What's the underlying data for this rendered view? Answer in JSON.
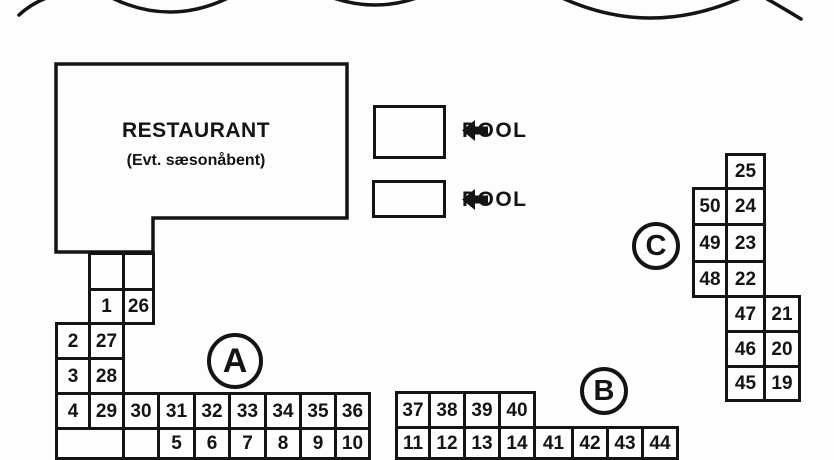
{
  "canvas": {
    "background_color": "#fdfdfd",
    "line_color": "#141414"
  },
  "restaurant": {
    "title": "RESTAURANT",
    "subtitle": "(Evt. sæsonåbent)"
  },
  "pools": [
    {
      "label": "POOL",
      "arrow_direction": "left"
    },
    {
      "label": "POOL",
      "arrow_direction": "left"
    }
  ],
  "blocks": [
    {
      "id": "block-a",
      "section_label": "A",
      "circle": {
        "cx": 235,
        "cy": 361,
        "r": 28,
        "font_size": 34
      },
      "cells": [
        {
          "label": "",
          "rect": [
            88,
            252,
            37,
            39
          ]
        },
        {
          "label": "",
          "rect": [
            122,
            252,
            33,
            39
          ]
        },
        {
          "label": "1",
          "rect": [
            88,
            288,
            37,
            37
          ]
        },
        {
          "label": "26",
          "rect": [
            122,
            288,
            33,
            37
          ]
        },
        {
          "label": "2",
          "rect": [
            55,
            322,
            36,
            38
          ]
        },
        {
          "label": "27",
          "rect": [
            88,
            322,
            37,
            38
          ]
        },
        {
          "label": "3",
          "rect": [
            55,
            357,
            36,
            38
          ]
        },
        {
          "label": "28",
          "rect": [
            88,
            357,
            37,
            38
          ]
        },
        {
          "label": "4",
          "rect": [
            55,
            392,
            36,
            38
          ]
        },
        {
          "label": "29",
          "rect": [
            88,
            392,
            37,
            38
          ]
        },
        {
          "label": "30",
          "rect": [
            122,
            392,
            38,
            38
          ]
        },
        {
          "label": "31",
          "rect": [
            157,
            392,
            39,
            38
          ]
        },
        {
          "label": "32",
          "rect": [
            193,
            392,
            38,
            38
          ]
        },
        {
          "label": "33",
          "rect": [
            228,
            392,
            39,
            38
          ]
        },
        {
          "label": "34",
          "rect": [
            264,
            392,
            38,
            38
          ]
        },
        {
          "label": "35",
          "rect": [
            299,
            392,
            38,
            38
          ]
        },
        {
          "label": "36",
          "rect": [
            334,
            392,
            37,
            38
          ]
        },
        {
          "label": "",
          "rect": [
            55,
            427,
            70,
            33
          ]
        },
        {
          "label": "",
          "rect": [
            122,
            427,
            38,
            33
          ]
        },
        {
          "label": "5",
          "rect": [
            157,
            427,
            39,
            33
          ]
        },
        {
          "label": "6",
          "rect": [
            193,
            427,
            38,
            33
          ]
        },
        {
          "label": "7",
          "rect": [
            228,
            427,
            39,
            33
          ]
        },
        {
          "label": "8",
          "rect": [
            264,
            427,
            38,
            33
          ]
        },
        {
          "label": "9",
          "rect": [
            299,
            427,
            38,
            33
          ]
        },
        {
          "label": "10",
          "rect": [
            334,
            427,
            37,
            33
          ]
        }
      ]
    },
    {
      "id": "block-b",
      "section_label": "B",
      "circle": {
        "cx": 604,
        "cy": 391,
        "r": 24,
        "font_size": 29
      },
      "cells": [
        {
          "label": "37",
          "rect": [
            395,
            391,
            36,
            38
          ]
        },
        {
          "label": "38",
          "rect": [
            428,
            391,
            38,
            38
          ]
        },
        {
          "label": "39",
          "rect": [
            463,
            391,
            38,
            38
          ]
        },
        {
          "label": "40",
          "rect": [
            498,
            391,
            38,
            38
          ]
        },
        {
          "label": "11",
          "rect": [
            395,
            426,
            36,
            34
          ]
        },
        {
          "label": "12",
          "rect": [
            428,
            426,
            38,
            34
          ]
        },
        {
          "label": "13",
          "rect": [
            463,
            426,
            38,
            34
          ]
        },
        {
          "label": "14",
          "rect": [
            498,
            426,
            38,
            34
          ]
        },
        {
          "label": "41",
          "rect": [
            533,
            426,
            41,
            34
          ]
        },
        {
          "label": "42",
          "rect": [
            571,
            426,
            38,
            34
          ]
        },
        {
          "label": "43",
          "rect": [
            606,
            426,
            38,
            34
          ]
        },
        {
          "label": "44",
          "rect": [
            641,
            426,
            38,
            34
          ]
        }
      ]
    },
    {
      "id": "block-c",
      "section_label": "C",
      "circle": {
        "cx": 656,
        "cy": 246,
        "r": 24,
        "font_size": 29
      },
      "cells": [
        {
          "label": "25",
          "rect": [
            725,
            153,
            41,
            37
          ]
        },
        {
          "label": "50",
          "rect": [
            692,
            187,
            36,
            39
          ]
        },
        {
          "label": "24",
          "rect": [
            725,
            187,
            41,
            39
          ]
        },
        {
          "label": "49",
          "rect": [
            692,
            223,
            36,
            40
          ]
        },
        {
          "label": "23",
          "rect": [
            725,
            223,
            41,
            40
          ]
        },
        {
          "label": "48",
          "rect": [
            692,
            260,
            36,
            38
          ]
        },
        {
          "label": "22",
          "rect": [
            725,
            260,
            41,
            38
          ]
        },
        {
          "label": "47",
          "rect": [
            725,
            295,
            41,
            38
          ]
        },
        {
          "label": "21",
          "rect": [
            763,
            295,
            38,
            38
          ]
        },
        {
          "label": "46",
          "rect": [
            725,
            330,
            41,
            38
          ]
        },
        {
          "label": "20",
          "rect": [
            763,
            330,
            38,
            38
          ]
        },
        {
          "label": "45",
          "rect": [
            725,
            365,
            41,
            37
          ]
        },
        {
          "label": "19",
          "rect": [
            763,
            365,
            38,
            37
          ]
        }
      ]
    }
  ]
}
